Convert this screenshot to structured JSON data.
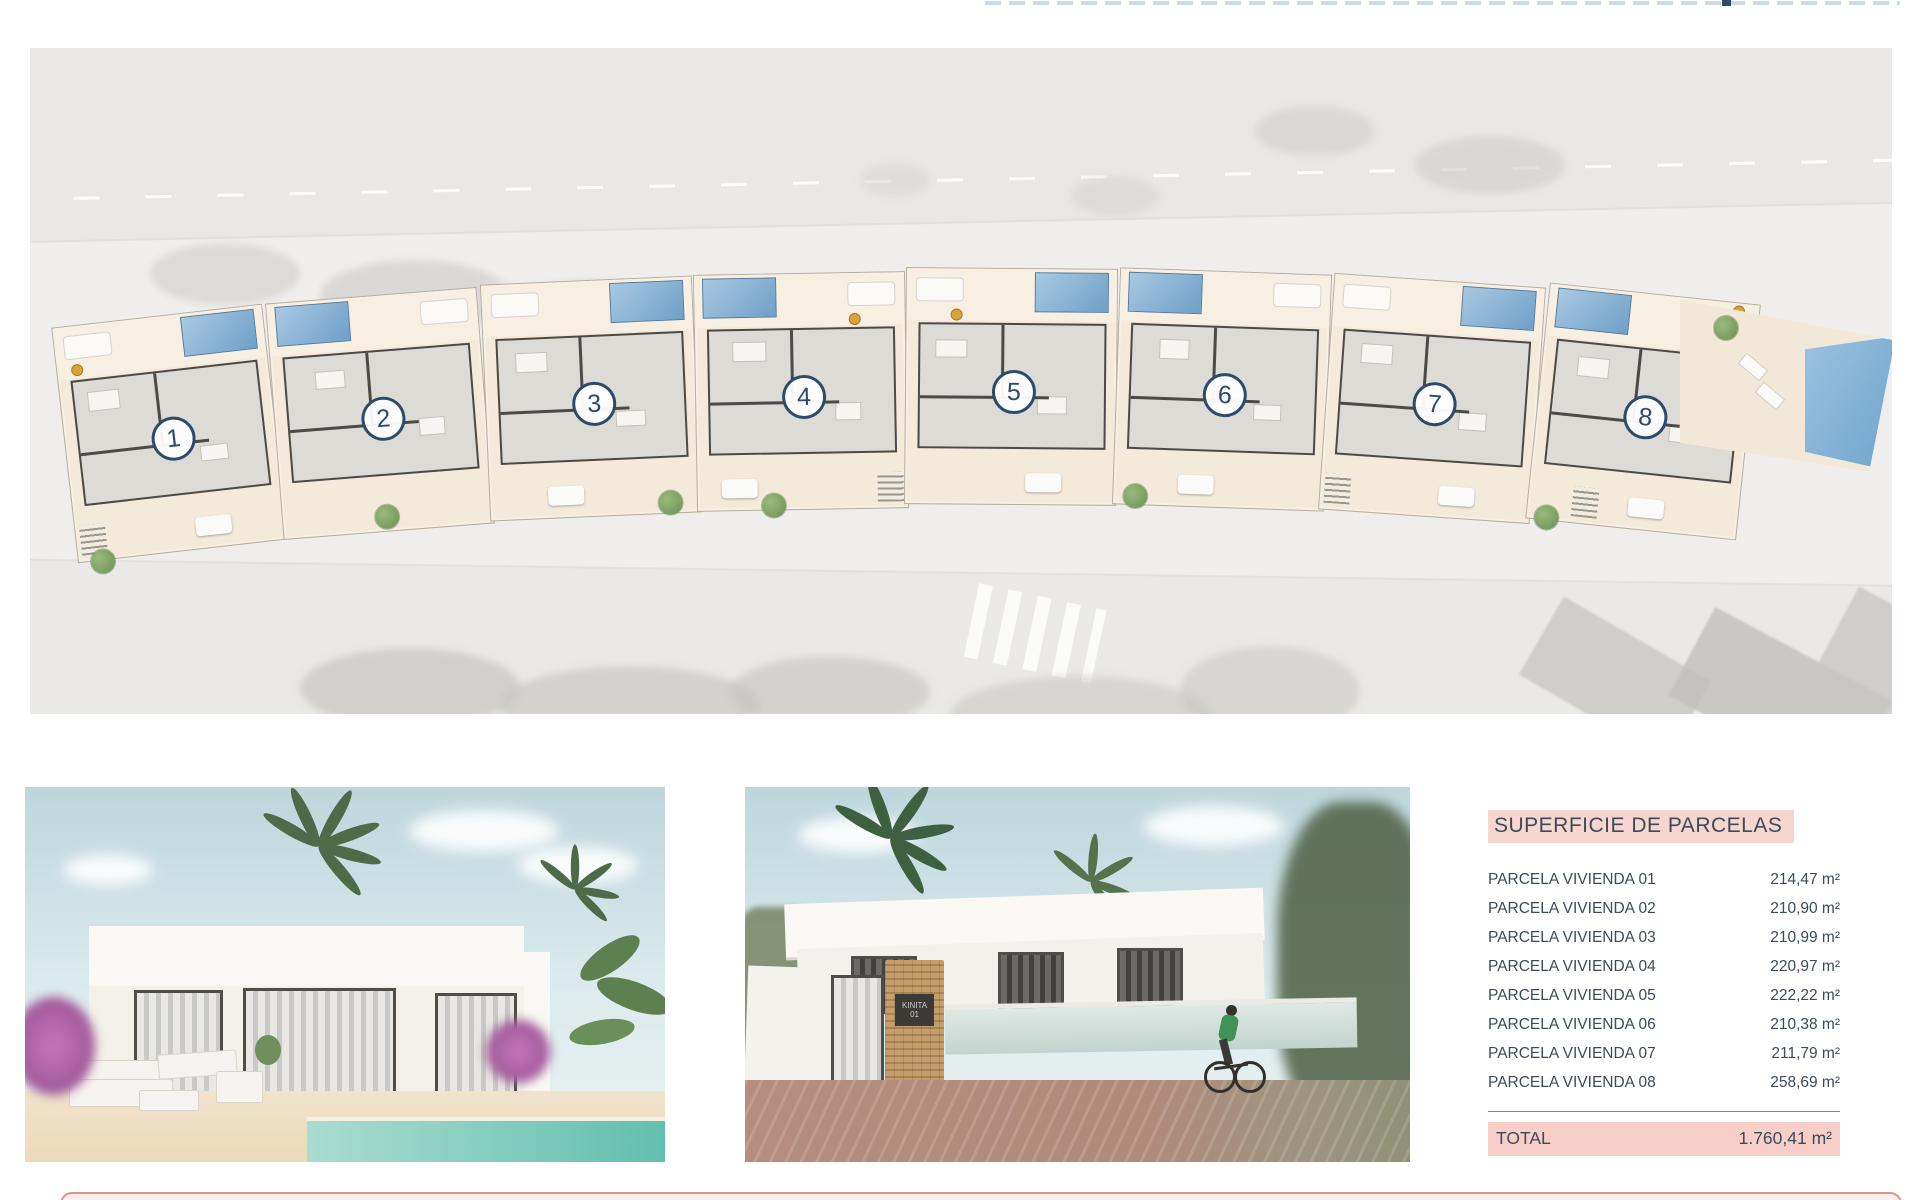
{
  "table": {
    "title": "SUPERFICIE DE PARCELAS",
    "rows": [
      {
        "label": "PARCELA VIVIENDA 01",
        "value": "214,47 m²"
      },
      {
        "label": "PARCELA VIVIENDA 02",
        "value": "210,90 m²"
      },
      {
        "label": "PARCELA VIVIENDA 03",
        "value": "210,99 m²"
      },
      {
        "label": "PARCELA VIVIENDA 04",
        "value": "220,97 m²"
      },
      {
        "label": "PARCELA VIVIENDA 05",
        "value": "222,22 m²"
      },
      {
        "label": "PARCELA VIVIENDA 06",
        "value": "210,38 m²"
      },
      {
        "label": "PARCELA VIVIENDA 07",
        "value": "211,79 m²"
      },
      {
        "label": "PARCELA VIVIENDA 08",
        "value": "258,69 m²"
      }
    ],
    "total_label": "TOTAL",
    "total_value": "1.760,41 m²"
  },
  "site_plan": {
    "units": [
      {
        "number": "1"
      },
      {
        "number": "2"
      },
      {
        "number": "3"
      },
      {
        "number": "4"
      },
      {
        "number": "5"
      },
      {
        "number": "6"
      },
      {
        "number": "7"
      },
      {
        "number": "8"
      }
    ]
  },
  "sign": {
    "line1": "KINITA",
    "line2": "01"
  },
  "colors": {
    "accent_pink": "#f8d6d0",
    "accent_pink_strong": "#f7cfc8",
    "footer_border": "#df9288",
    "navy_badge": "#2d4a6b",
    "table_text": "#3c4a5a",
    "pool_blue": "#6f9fc9"
  }
}
